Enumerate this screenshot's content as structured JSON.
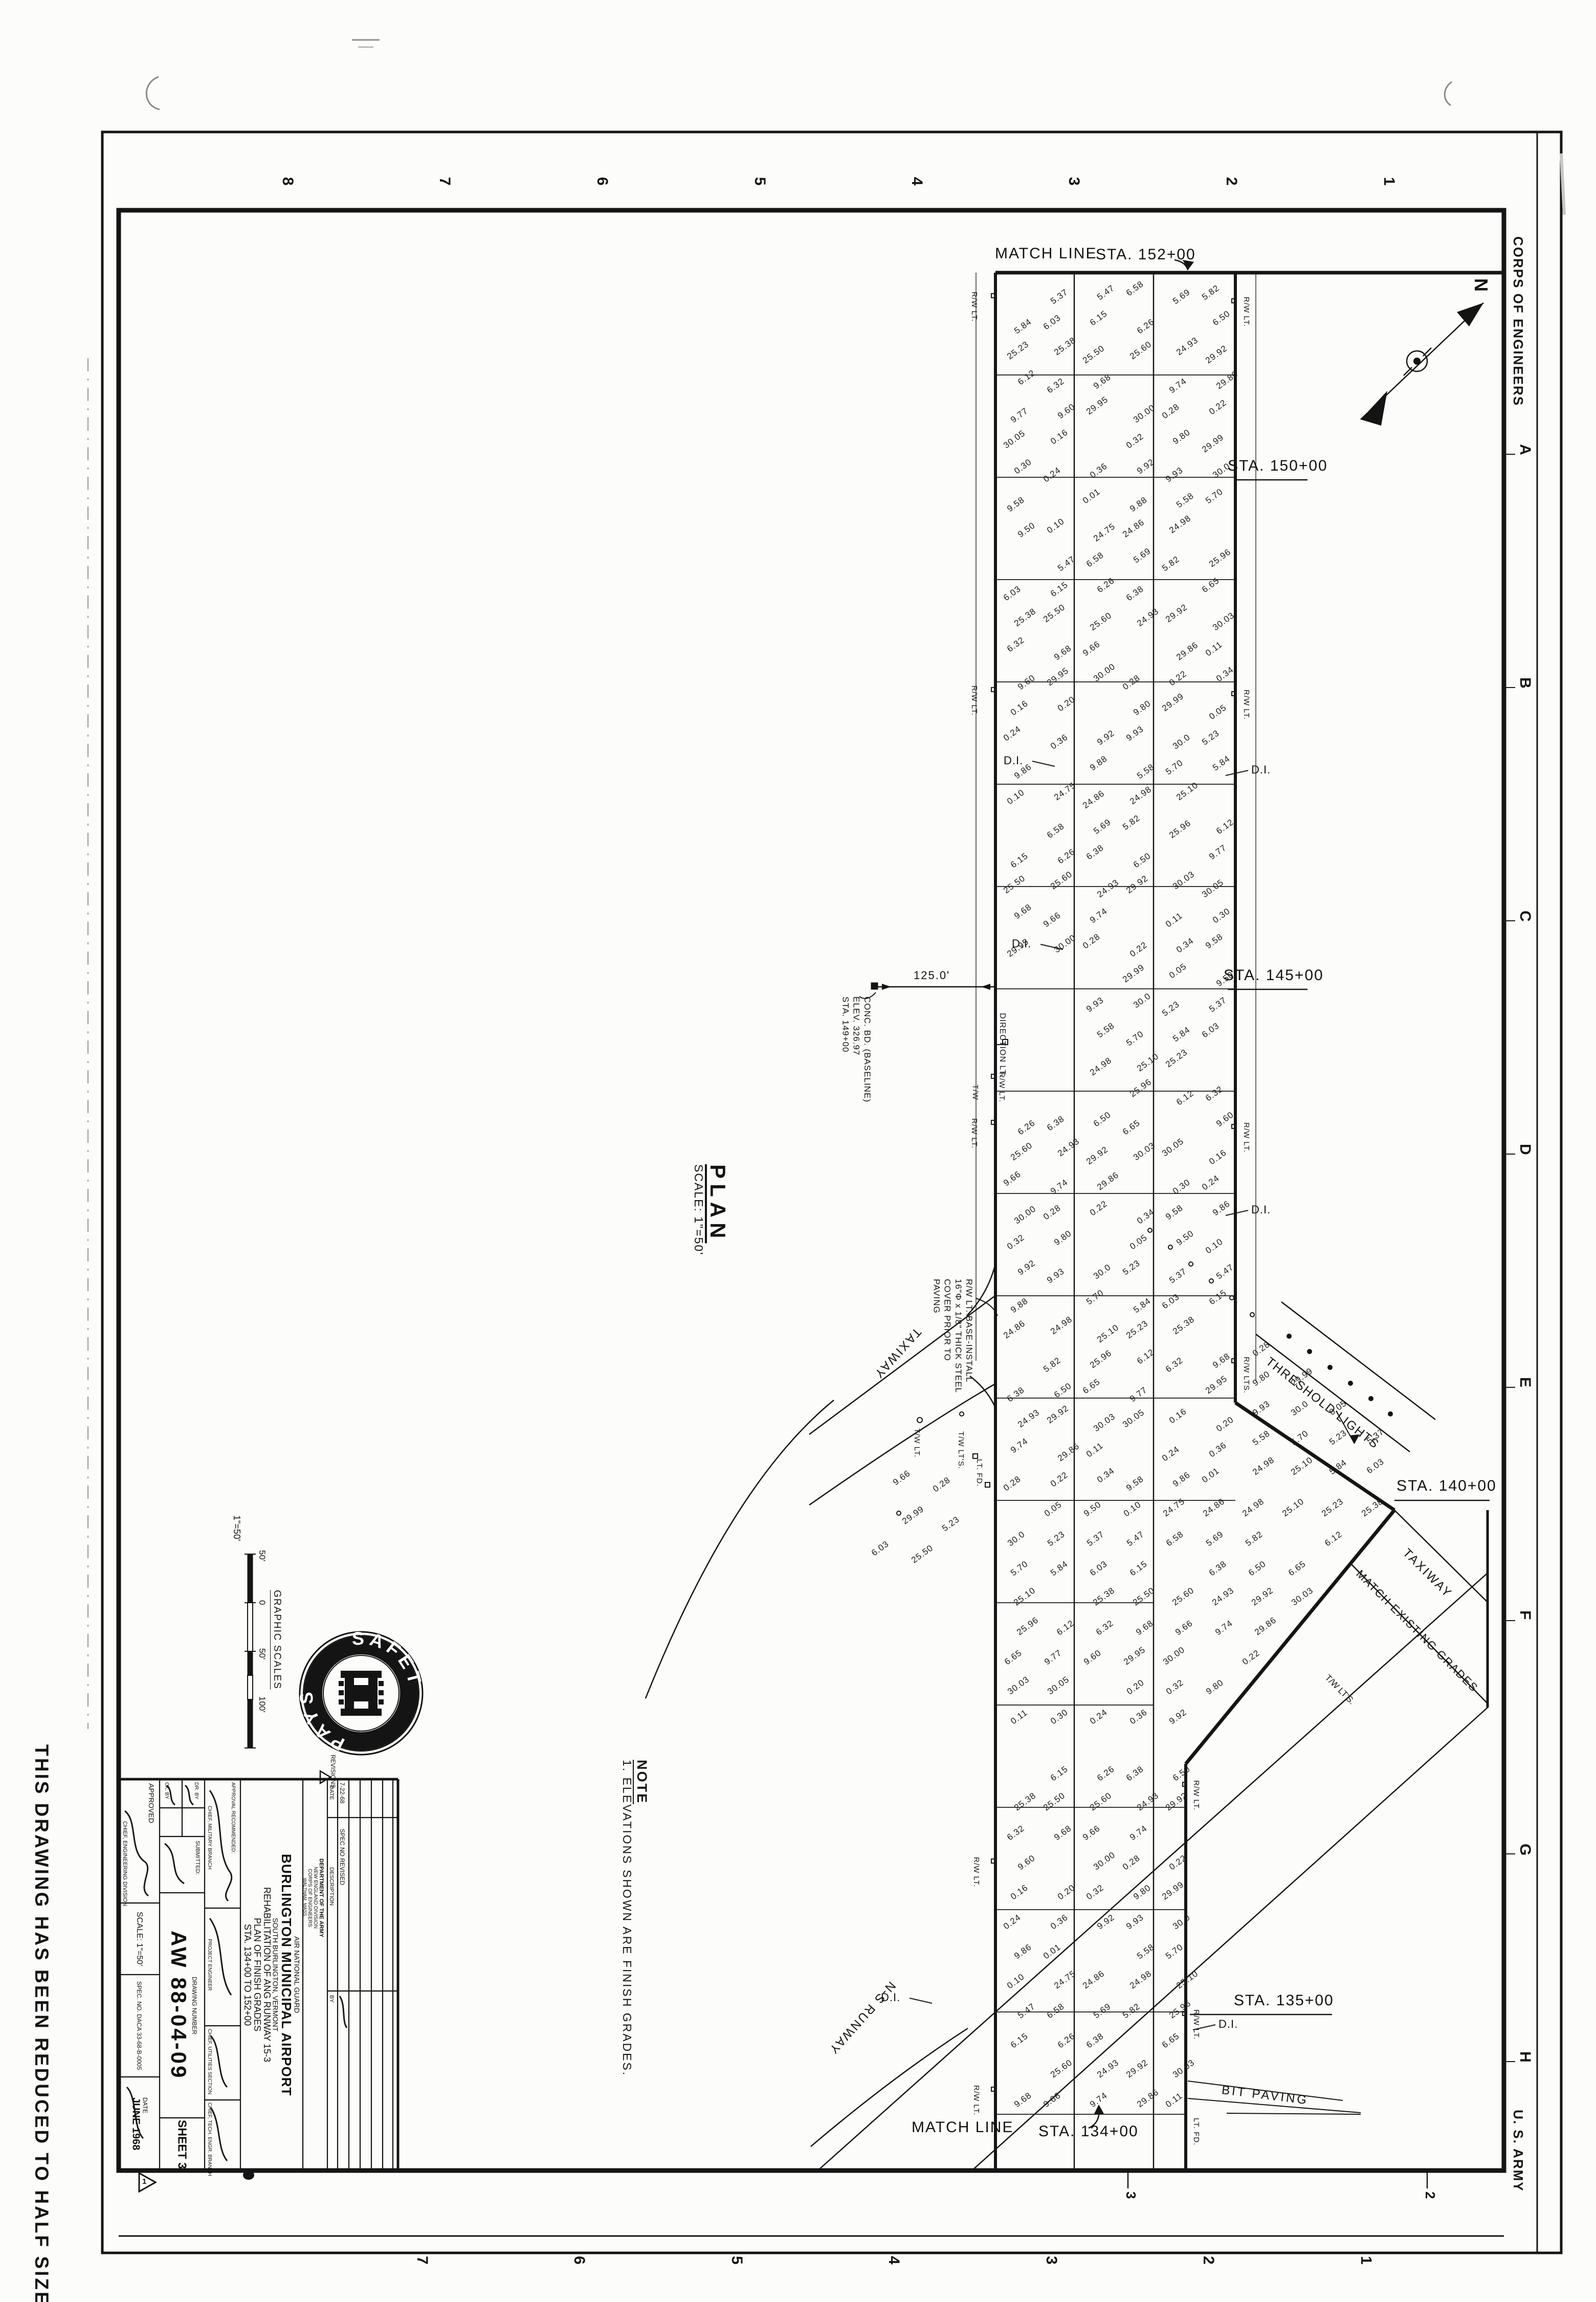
{
  "sheet": {
    "stamp_left": "THIS DRAWING HAS BEEN REDUCED TO HALF SIZE",
    "corps": "CORPS OF ENGINEERS",
    "army": "U. S. ARMY",
    "north": "N",
    "margin_top_numbers": [
      "8",
      "7",
      "6",
      "5",
      "4",
      "3",
      "2",
      "1"
    ],
    "margin_bottom_numbers": [
      "7",
      "6",
      "5",
      "4",
      "3",
      "2",
      "1"
    ],
    "margin_inner_numbers": [
      "3",
      "2"
    ],
    "margin_right_letters": [
      "A",
      "B",
      "C",
      "D",
      "E",
      "F",
      "G",
      "H"
    ]
  },
  "plan": {
    "title": "PLAN",
    "scale_note": "SCALE: 1\"=50'",
    "match_line_top": "MATCH LINE",
    "sta_152": "STA. 152+00",
    "sta_150": "STA. 150+00",
    "sta_145": "STA. 145+00",
    "sta_140": "STA. 140+00",
    "sta_135": "STA. 135+00",
    "sta_134": "STA. 134+00",
    "match_line_bottom": "MATCH LINE",
    "bit_paving": "BIT PAVING",
    "ns_runway": "N-S RUNWAY",
    "taxiway": "TAXIWAY",
    "match_existing": "MATCH EXISTING GRADES",
    "threshold_lights": "THRESHOLD LIGHTS",
    "dim_125": "125.0'",
    "baseline_callout": [
      "CONC. BD. (BASELINE)",
      "ELEV. 326.97",
      "STA. 149+00"
    ],
    "cover_callout": [
      "R/W LT. BASE-INSTALL",
      "16\"Φ x 1/8\" THICK STEEL",
      "COVER PRIOR TO",
      "PAVING"
    ],
    "direction_lt": "DIRECTION LT.",
    "rw_lt": "R/W LT.",
    "rw_lts": "R/W LTS.",
    "tw_lt": "T/W LT.",
    "tw_lts": "T/W LT'S.",
    "lt_fd": "LT. FD.",
    "tw": "T/W",
    "di": "D.I.",
    "note_title": "NOTE",
    "note_body": "1. ELEVATIONS SHOWN ARE FINISH GRADES.",
    "spot_elevations": [
      "5.23",
      "5.58",
      "24.75",
      "5.37",
      "5.70",
      "24.86",
      "5.47",
      "5.84",
      "24.98",
      "6.58",
      "6.03",
      "25.10",
      "5.69",
      "6.15",
      "25.23",
      "5.82",
      "6.26",
      "25.38",
      "25.96",
      "6.38",
      "25.50",
      "6.12",
      "6.50",
      "25.60",
      "6.32",
      "6.65",
      "24.93",
      "9.68",
      "9.77",
      "29.92",
      "9.66",
      "9.60",
      "30.03",
      "9.74",
      "29.95",
      "30.05",
      "29.86",
      "30.00",
      "0.16",
      "0.11",
      "0.28",
      "0.20",
      "0.30",
      "0.22",
      "0.32",
      "0.24",
      "0.34",
      "9.80",
      "0.36",
      "9.58",
      "29.99",
      "9.92",
      "9.86",
      "0.05",
      "9.93",
      "0.01",
      "9.50",
      "30.0",
      "9.88",
      "0.10"
    ]
  },
  "graphic_scale": {
    "title": "GRAPHIC SCALES",
    "ratio": "1\"=50'",
    "ticks": [
      "50'",
      "0",
      "50'",
      "100'"
    ]
  },
  "safety_logo": {
    "word1": "SAFETY",
    "word2": "PAYS"
  },
  "title_block": {
    "agency": [
      "DEPARTMENT OF THE ARMY",
      "NEW ENGLAND DIVISION",
      "CORPS OF ENGINEERS",
      "WALTHAM, MASS."
    ],
    "project": [
      "AIR NATIONAL GUARD",
      "BURLINGTON MUNICIPAL AIRPORT",
      "SOUTH BURLINGTON, VERMONT",
      "REHABILITATION OF ANG RUNWAY 15-3",
      "PLAN OF FINISH GRADES",
      "STA. 134+00 TO 152+00"
    ],
    "approved_label": "APPROVED",
    "approved_title": "CHIEF, ENGINEERING DIVISION",
    "scale": "SCALE: 1\"=50'",
    "spec": "SPEC. NO. DACA 33-68-B-0005",
    "date_label": "DATE",
    "date": "JUNE 1968",
    "drawing_number_label": "DRAWING NUMBER",
    "drawing_number": "AW 88-04-09",
    "sheet": "SHEET 3",
    "submitted": "SUBMITTED:",
    "dr_by": "DR. BY",
    "ck_by": "CK. BY",
    "approval_rec": "APPROVAL RECOMMENDED:",
    "chief_military": "CHIEF, MILITARY BRANCH",
    "project_engineer": "PROJECT ENGINEER",
    "chief_utilities": "CHIEF, UTILITIES SECTION",
    "chief_tech": "CHIEF, TECH. ENGR. BRANCH"
  },
  "revision": {
    "table_label": "REVISIONS",
    "marker": "1",
    "labels": {
      "date": "DATE",
      "description": "DESCRIPTION",
      "by": "BY"
    },
    "entry": {
      "date": "7-22-68",
      "description": "SPEC NO REVISED"
    }
  }
}
